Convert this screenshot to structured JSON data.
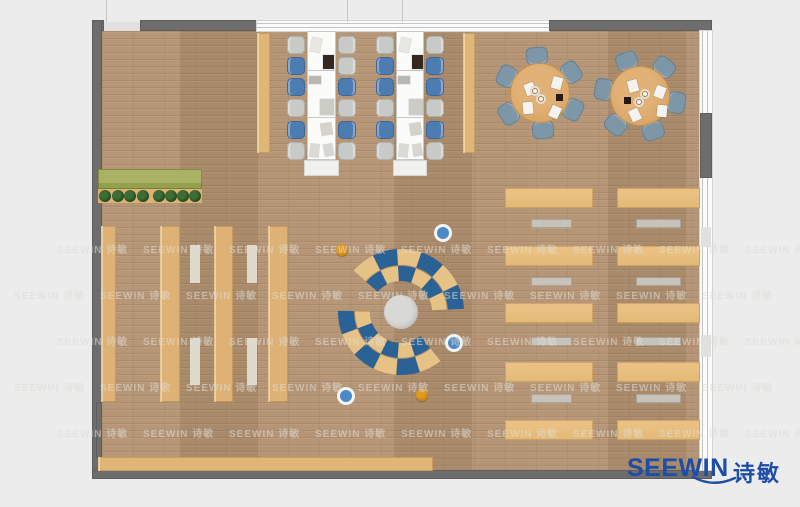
{
  "scene": {
    "width": 800,
    "height": 507,
    "bg": "#ececec"
  },
  "floor": {
    "x": 102,
    "y": 31,
    "w": 598,
    "h": 439
  },
  "walls": {
    "segments": [
      {
        "name": "wall-top-corner-left",
        "x": 92,
        "y": 20,
        "w": 12,
        "h": 11,
        "kind": "solid"
      },
      {
        "name": "wall-top-light-gap",
        "x": 104,
        "y": 22,
        "w": 36,
        "h": 9,
        "kind": "light"
      },
      {
        "name": "wall-top-a",
        "x": 140,
        "y": 20,
        "w": 117,
        "h": 11,
        "kind": "solid"
      },
      {
        "name": "window-top",
        "x": 257,
        "y": 21,
        "w": 292,
        "h": 10,
        "kind": "window-h"
      },
      {
        "name": "wall-top-b",
        "x": 549,
        "y": 20,
        "w": 163,
        "h": 11,
        "kind": "solid"
      },
      {
        "name": "wall-left",
        "x": 92,
        "y": 20,
        "w": 10,
        "h": 459,
        "kind": "solid"
      },
      {
        "name": "wall-left-stub",
        "x": 96,
        "y": 402,
        "w": 6,
        "h": 56,
        "kind": "solid"
      },
      {
        "name": "wall-bottom",
        "x": 92,
        "y": 470,
        "w": 620,
        "h": 9,
        "kind": "solid"
      },
      {
        "name": "window-right",
        "x": 700,
        "y": 31,
        "w": 12,
        "h": 439,
        "kind": "window-v"
      },
      {
        "name": "wall-right-solid",
        "x": 700,
        "y": 113,
        "w": 12,
        "h": 65,
        "kind": "solid"
      },
      {
        "name": "wall-right-light-a",
        "x": 701,
        "y": 227,
        "w": 10,
        "h": 20,
        "kind": "light"
      },
      {
        "name": "wall-right-light-b",
        "x": 701,
        "y": 335,
        "w": 10,
        "h": 22,
        "kind": "light"
      }
    ],
    "mullions": [
      {
        "x": 106,
        "y": 0,
        "h": 22
      },
      {
        "x": 347,
        "y": 0,
        "h": 22
      },
      {
        "x": 402,
        "y": 0,
        "h": 22
      }
    ]
  },
  "planter": {
    "x": 98,
    "y": 169,
    "w": 104,
    "h": 20,
    "top_color": "#aab364",
    "band_color": "#93a04e",
    "base_y": 189,
    "base_h": 14,
    "base_color": "#dcb171",
    "tree_color_outer": "#1e4a22",
    "tree_color_inner": "#3c6d34",
    "tree_y": 196,
    "tree_r": 6,
    "tree_xs": [
      105,
      118,
      130,
      143,
      159,
      171,
      183,
      195
    ]
  },
  "shelves": {
    "color": "#ddb274",
    "columns": [
      {
        "x": 101,
        "y": 226,
        "w": 15,
        "h": 176
      },
      {
        "x": 160,
        "y": 226,
        "w": 20,
        "h": 176
      },
      {
        "x": 214,
        "y": 226,
        "w": 19,
        "h": 176
      },
      {
        "x": 268,
        "y": 226,
        "w": 20,
        "h": 176
      }
    ],
    "aisle_color": "rgba(230,226,216,0.9)",
    "aisles": [
      {
        "x": 190,
        "y": 245,
        "w": 10,
        "h": 38
      },
      {
        "x": 190,
        "y": 338,
        "w": 10,
        "h": 47
      },
      {
        "x": 247,
        "y": 245,
        "w": 10,
        "h": 38
      },
      {
        "x": 247,
        "y": 338,
        "w": 10,
        "h": 47
      }
    ],
    "bottom_shelf": {
      "x": 98,
      "y": 457,
      "w": 335,
      "h": 14,
      "color": "#e0b678"
    }
  },
  "workstations": {
    "desk_color": "#fbfbfa",
    "desk_border": "#c6c6c3",
    "cabinet_color": "#f0f0ee",
    "divider_ys": [
      70,
      117
    ],
    "chair_w": 18,
    "chair_h": 18,
    "chair_ys": [
      36,
      57,
      78,
      99,
      121,
      142
    ],
    "chair_colors": {
      "gray": "#c8cac8",
      "blue": "#4d7cb0"
    },
    "chair_borders": {
      "gray": "#aeb0ae",
      "blue": "#3c689c"
    },
    "side_strip_color": "#dfb879",
    "side_strips": [
      {
        "x": 257,
        "y": 33,
        "w": 13,
        "h": 120
      },
      {
        "x": 463,
        "y": 33,
        "w": 12,
        "h": 120
      }
    ],
    "items": [
      {
        "dx": 4,
        "dy": 7,
        "w": 10,
        "h": 14,
        "c": "#e9e7e1",
        "rot": 12
      },
      {
        "dx": 16,
        "dy": 24,
        "w": 11,
        "h": 14,
        "c": "#35281f",
        "rot": 0
      },
      {
        "dx": 2,
        "dy": 45,
        "w": 12,
        "h": 8,
        "c": "#b8b8b2",
        "rot": 0
      },
      {
        "dx": 13,
        "dy": 68,
        "w": 14,
        "h": 16,
        "c": "#ccccc7",
        "rot": 0
      },
      {
        "dx": 14,
        "dy": 92,
        "w": 11,
        "h": 12,
        "c": "#d4d2cb",
        "rot": -8
      },
      {
        "dx": 3,
        "dy": 113,
        "w": 9,
        "h": 13,
        "c": "#dcdad4",
        "rot": 6
      },
      {
        "dx": 17,
        "dy": 113,
        "w": 9,
        "h": 12,
        "c": "#d8d6d0",
        "rot": -10
      }
    ],
    "columns": [
      {
        "x": 307,
        "y": 31,
        "w": 29,
        "h": 129,
        "left_chairs": [
          "gray",
          "blue",
          "blue",
          "gray",
          "blue",
          "gray"
        ],
        "right_chairs": [
          "gray",
          "gray",
          "blue",
          "gray",
          "blue",
          "gray"
        ]
      },
      {
        "x": 396,
        "y": 31,
        "w": 28,
        "h": 129,
        "left_chairs": [
          "gray",
          "blue",
          "blue",
          "gray",
          "blue",
          "gray"
        ],
        "right_chairs": [
          "gray",
          "blue",
          "blue",
          "gray",
          "blue",
          "gray"
        ]
      }
    ]
  },
  "round_tables": {
    "table_color": "#d8a566",
    "table_border": "#c18f4e",
    "chair_color": "#7d97a9",
    "chair_border": "#64808f",
    "chair_dist": 37,
    "radius": 30,
    "chair_w": 22,
    "chair_h": 19,
    "tables": [
      {
        "cx": 540,
        "cy": 93,
        "angles": [
          266,
          326,
          26,
          86,
          146,
          206
        ],
        "flip": 1
      },
      {
        "cx": 640,
        "cy": 96,
        "angles": [
          250,
          310,
          10,
          70,
          130,
          190
        ],
        "flip": -1
      }
    ],
    "papers": [
      {
        "dx": -15,
        "dy": -10,
        "rot": -20
      },
      {
        "dx": 12,
        "dy": -16,
        "rot": 15
      },
      {
        "dx": -17,
        "dy": 9,
        "rot": -5
      },
      {
        "dx": 10,
        "dy": 13,
        "rot": 25
      }
    ],
    "plates": [
      {
        "dx": -5,
        "dy": -2
      },
      {
        "dx": 1,
        "dy": 6
      }
    ],
    "dark_item": {
      "dx": 16,
      "dy": 1,
      "w": 7,
      "h": 7,
      "c": "#241a12"
    }
  },
  "desk_grid": {
    "tan_color": "#e3b976",
    "gray_color": "#c7c3ba",
    "tan_cols": [
      {
        "x": 505,
        "w": 88
      },
      {
        "x": 617,
        "w": 83
      }
    ],
    "tan_rows": [
      188,
      246,
      303,
      362,
      420
    ],
    "tan_h": 20,
    "gray_cols": [
      {
        "x": 531,
        "w": 41
      },
      {
        "x": 636,
        "w": 45
      }
    ],
    "gray_rows": [
      219,
      277,
      337,
      394
    ],
    "gray_h": 9
  },
  "lounge": {
    "cx": 401,
    "cy": 312,
    "center_r": 17,
    "center_color": "#d8d8d6",
    "blue": "#2a6295",
    "tan": "#e6c287",
    "arcs": [
      {
        "r0": 47,
        "r1": 63,
        "a0": 221,
        "a1": 357,
        "n": 6,
        "first": "tan"
      },
      {
        "r0": 31,
        "r1": 46,
        "a0": 221,
        "a1": 357,
        "n": 6,
        "first": "blue"
      },
      {
        "r0": 47,
        "r1": 63,
        "a0": 51,
        "a1": 181,
        "n": 6,
        "first": "tan"
      },
      {
        "r0": 31,
        "r1": 46,
        "a0": 51,
        "a1": 181,
        "n": 6,
        "first": "blue"
      }
    ],
    "dots": [
      {
        "x": 342,
        "y": 250,
        "r": 6,
        "kind": "orange"
      },
      {
        "x": 443,
        "y": 233,
        "r": 7,
        "kind": "blue"
      },
      {
        "x": 454,
        "y": 343,
        "r": 7,
        "kind": "blue"
      },
      {
        "x": 346,
        "y": 396,
        "r": 7,
        "kind": "blue"
      },
      {
        "x": 422,
        "y": 395,
        "r": 6,
        "kind": "orange"
      }
    ],
    "dot_colors": {
      "orange": "#c8830e",
      "blue": "#4c8ac6",
      "blue_ring": "#f2f4f6"
    }
  },
  "watermark": {
    "text": "SEEWIN 诗敏",
    "color": "rgba(224,221,214,0.55)",
    "font_size": 10,
    "x_start": 14,
    "x_step": 86,
    "count": 9,
    "rows": [
      {
        "y": 241,
        "off": 43
      },
      {
        "y": 287,
        "off": 0
      },
      {
        "y": 333,
        "off": 43
      },
      {
        "y": 379,
        "off": 0
      },
      {
        "y": 425,
        "off": 43
      }
    ]
  },
  "logo": {
    "text": "SEEWIN",
    "cn": "诗敏",
    "color": "#1d4da6"
  }
}
